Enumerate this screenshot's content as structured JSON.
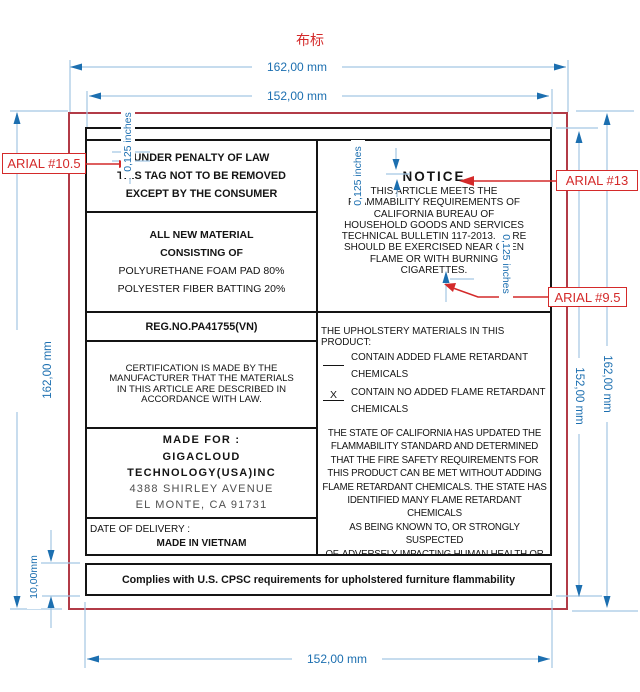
{
  "title": "布标",
  "colors": {
    "dimension_blue": "#1c6fb0",
    "dimension_line_blue": "#a3c6e3",
    "annotation_red": "#d42a2a",
    "fabric_outline_red": "#b23b47",
    "label_border_black": "#141414"
  },
  "dimensions": {
    "top_outer": "162,00 mm",
    "top_inner": "152,00 mm",
    "left_outer": "162,00 mm",
    "right_inner": "152,00 mm",
    "right_outer": "162,00 mm",
    "bottom_inner": "152,00 mm",
    "bar_height": "10,00mm",
    "margin_top_left": "0,125 inches",
    "margin_notice_top": "0,125 inches",
    "margin_notice_bottom": "0,125 inches"
  },
  "font_callouts": {
    "under_penalty": "ARIAL #10.5",
    "notice": "ARIAL #13",
    "body": "ARIAL #9.5"
  },
  "label": {
    "under_penalty": {
      "lines": [
        "UNDER PENALTY OF LAW",
        "THIS TAG NOT TO BE REMOVED",
        "EXCEPT BY THE CONSUMER"
      ]
    },
    "materials": {
      "heading1": "ALL NEW MATERIAL",
      "heading2": "CONSISTING OF",
      "items": [
        "POLYURETHANE FOAM PAD 80%",
        "POLYESTER FIBER BATTING 20%"
      ]
    },
    "reg_no": "REG.NO.PA41755(VN)",
    "certification": {
      "lines": [
        "CERTIFICATION IS MADE BY THE",
        "MANUFACTURER THAT THE MATERIALS",
        "IN THIS ARTICLE ARE DESCRIBED IN",
        "ACCORDANCE WITH LAW."
      ]
    },
    "made_for": {
      "heading": "MADE FOR :",
      "company1": "GIGACLOUD",
      "company2": "TECHNOLOGY(USA)INC",
      "address1": "4388 SHIRLEY AVENUE",
      "address2": "EL MONTE, CA 91731"
    },
    "delivery": {
      "label": "DATE OF DELIVERY :",
      "origin": "MADE IN VIETNAM"
    },
    "notice": {
      "heading": "NOTICE",
      "lines": [
        "THIS ARTICLE MEETS THE",
        "FLAMMABILITY REQUIREMENTS OF",
        "CALIFORNIA BUREAU OF",
        "HOUSEHOLD GOODS AND SERVICES",
        "TECHNICAL BULLETIN 117-2013. CARE",
        "SHOULD BE EXERCISED NEAR OPEN",
        "FLAME OR WITH BURNING",
        "CIGARETTES."
      ]
    },
    "upholstery": {
      "heading": "THE UPHOLSTERY MATERIALS IN THIS PRODUCT:",
      "option1": {
        "mark": "",
        "lines": [
          "CONTAIN ADDED FLAME RETARDANT",
          "CHEMICALS"
        ]
      },
      "option2": {
        "mark": "X",
        "lines": [
          "CONTAIN NO ADDED FLAME RETARDANT",
          "CHEMICALS"
        ]
      },
      "state_lines": [
        "THE STATE OF CALIFORNIA HAS UPDATED THE",
        "FLAMMABILITY STANDARD AND DETERMINED",
        "THAT THE FIRE SAFETY REQUIREMENTS FOR",
        "THIS PRODUCT CAN BE MET WITHOUT ADDING",
        "FLAME RETARDANT CHEMICALS. THE STATE HAS",
        "IDENTIFIED MANY FLAME RETARDANT CHEMICALS",
        "AS BEING KNOWN TO, OR STRONGLY SUSPECTED",
        "OF, ADVERSELY IMPACTING HUMAN HEALTH OR",
        "DEVELOPMENT."
      ]
    },
    "compliance": "Complies with U.S. CPSC requirements for upholstered furniture flammability"
  }
}
